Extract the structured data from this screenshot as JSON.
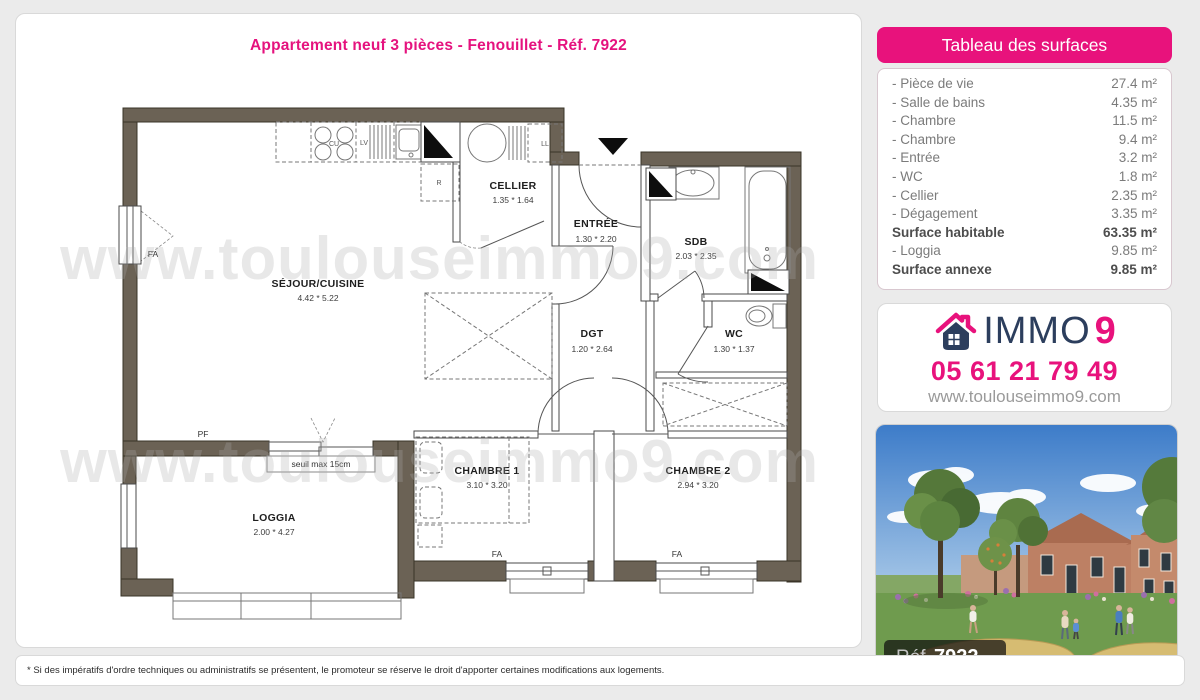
{
  "title": "Appartement neuf 3 pièces - Fenouillet - Réf. 7922",
  "watermark": "www.toulouseimmo9.com",
  "floorplan": {
    "rooms": {
      "sejour": {
        "name": "SÉJOUR/CUISINE",
        "dims": "4.42 * 5.22"
      },
      "cellier": {
        "name": "CELLIER",
        "dims": "1.35 * 1.64"
      },
      "entree": {
        "name": "ENTRÉE",
        "dims": "1.30 * 2.20"
      },
      "sdb": {
        "name": "SDB",
        "dims": "2.03 * 2.35"
      },
      "dgt": {
        "name": "DGT",
        "dims": "1.20 * 2.64"
      },
      "wc": {
        "name": "WC",
        "dims": "1.30 * 1.37"
      },
      "chambre1": {
        "name": "CHAMBRE 1",
        "dims": "3.10 * 3.20"
      },
      "chambre2": {
        "name": "CHAMBRE 2",
        "dims": "2.94 * 3.20"
      },
      "loggia": {
        "name": "LOGGIA",
        "dims": "2.00 * 4.27"
      }
    },
    "labels": {
      "fa": "FA",
      "pf": "PF",
      "seuil": "seuil max 15cm",
      "cu": "CU",
      "lv": "LV",
      "ll": "LL",
      "r": "R"
    }
  },
  "surface_table": {
    "header": "Tableau des surfaces",
    "rows": [
      {
        "label": "- Pièce de vie",
        "value": "27.4 m²",
        "bold": false
      },
      {
        "label": "- Salle de bains",
        "value": "4.35 m²",
        "bold": false
      },
      {
        "label": "- Chambre",
        "value": "11.5 m²",
        "bold": false
      },
      {
        "label": "- Chambre",
        "value": "9.4 m²",
        "bold": false
      },
      {
        "label": "- Entrée",
        "value": "3.2 m²",
        "bold": false
      },
      {
        "label": "- WC",
        "value": "1.8 m²",
        "bold": false
      },
      {
        "label": "- Cellier",
        "value": "2.35 m²",
        "bold": false
      },
      {
        "label": "- Dégagement",
        "value": "3.35 m²",
        "bold": false
      },
      {
        "label": "Surface habitable",
        "value": "63.35 m²",
        "bold": true
      },
      {
        "label": "- Loggia",
        "value": "9.85 m²",
        "bold": false
      },
      {
        "label": "Surface annexe",
        "value": "9.85 m²",
        "bold": true
      }
    ]
  },
  "agency": {
    "brand": "IMMO",
    "brand_suffix": "9",
    "phone": "05 61 21 79 49",
    "website": "www.toulouseimmo9.com"
  },
  "photo": {
    "ref_label": "Réf.",
    "ref_value": "7922"
  },
  "footnote": "* Si des impératifs d'ordre techniques ou administratifs se présentent, le promoteur se réserve le droit d'apporter certaines modifications aux logements.",
  "colors": {
    "pink": "#e8127c",
    "wall": "#6b6255",
    "navy": "#2c3e5d"
  }
}
